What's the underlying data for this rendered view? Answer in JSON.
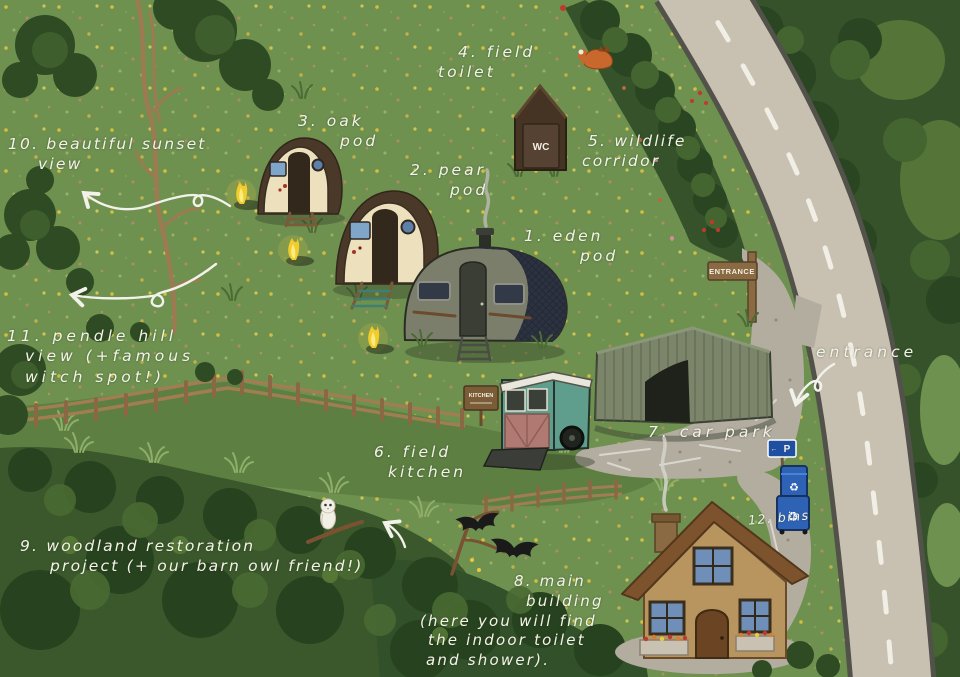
{
  "map": {
    "kind": "illustrated glamping campsite map",
    "numbered_locations": [
      {
        "number": "1",
        "name": "eden pod"
      },
      {
        "number": "2",
        "name": "pear pod"
      },
      {
        "number": "3",
        "name": "oak pod"
      },
      {
        "number": "4",
        "name": "field toilet"
      },
      {
        "number": "5",
        "name": "wildlife corridor"
      },
      {
        "number": "6",
        "name": "field kitchen"
      },
      {
        "number": "7",
        "name": "car park"
      },
      {
        "number": "8",
        "name": "main building (here you will find the indoor toilet and shower)."
      },
      {
        "number": "9",
        "name": "woodland restoration project (+ our barn owl friend!)"
      },
      {
        "number": "10",
        "name": "beautiful sunset view"
      },
      {
        "number": "11",
        "name": "pendle hill view (+famous witch spot!)"
      },
      {
        "number": "12",
        "name": "bins"
      }
    ]
  },
  "labels": {
    "eden_pod": [
      "1. eden",
      "pod"
    ],
    "pear_pod": [
      "2. pear",
      "pod"
    ],
    "oak_pod": [
      "3. oak",
      "pod"
    ],
    "field_toilet": [
      "4. field",
      "toilet"
    ],
    "wildlife_corridor": [
      "5. wildlife",
      "corridor"
    ],
    "field_kitchen": [
      "6. field",
      "kitchen"
    ],
    "car_park": [
      "7. car park"
    ],
    "main_building": [
      "8. main",
      "building",
      "(here you will find",
      "the indoor toilet",
      "and shower)."
    ],
    "woodland_restoration": [
      "9. woodland restoration",
      "project (+ our barn owl friend!)"
    ],
    "sunset_view": [
      "10. beautiful sunset",
      "view"
    ],
    "pendle_hill": [
      "11. pendle hill",
      "view (+famous",
      "witch spot!)"
    ],
    "bins": [
      "12. bins"
    ],
    "entrance_handwritten": [
      "entrance"
    ]
  },
  "signs": {
    "entrance_board": "ENTRANCE",
    "toilet_door": "WC",
    "kitchen_board": "KITCHEN",
    "parking_letter": "P",
    "parking_arrow": "←",
    "recycle_icon": "♻"
  },
  "wildlife_illustrations": [
    "sleeping fox",
    "barn owl",
    "bats"
  ],
  "colors": {
    "meadow": "#6E9150",
    "woodland_dark": "#2F4B24",
    "road": "#C8C1B2",
    "gravel": "#B3ADA0",
    "handwriting": "#F5F3E8",
    "barn_green": "#7B8569",
    "pod_cream": "#ECE0BD",
    "pod_roof_brown": "#4A3828",
    "eden_body": "#7C7E6C",
    "eden_roof_navy": "#2C3240",
    "horsebox_teal": "#5F9E8C",
    "horsebox_pink": "#B07A72",
    "cottage_stone": "#B8955E",
    "cottage_roof": "#7D532E",
    "window_blue": "#6F8FB8",
    "bin_blue": "#2E62B5",
    "flame_yellow": "#F2CC2E",
    "fence_brown": "#9B7A50"
  }
}
